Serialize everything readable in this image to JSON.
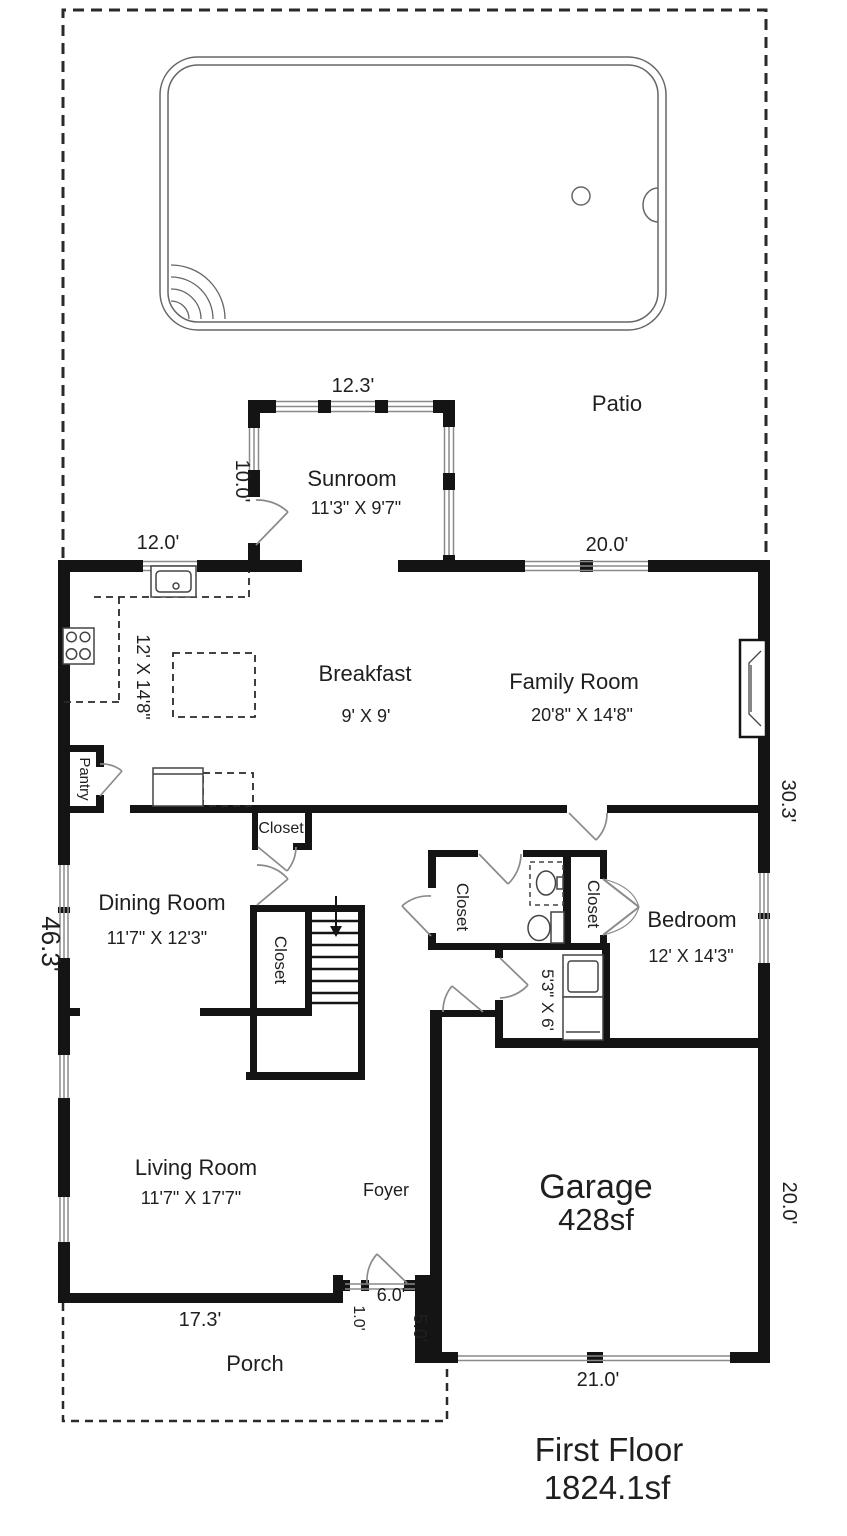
{
  "title": {
    "name": "First Floor",
    "area": "1824.1sf"
  },
  "outdoor": {
    "patio": "Patio",
    "porch": "Porch"
  },
  "rooms": {
    "sunroom": {
      "name": "Sunroom",
      "dims": "11'3\" X 9'7\""
    },
    "kitchen": {
      "dims": "12' X 14'8\""
    },
    "breakfast": {
      "name": "Breakfast",
      "dims": "9' X 9'"
    },
    "family_room": {
      "name": "Family Room",
      "dims": "20'8\" X 14'8\""
    },
    "dining_room": {
      "name": "Dining Room",
      "dims": "11'7\" X 12'3\""
    },
    "bedroom": {
      "name": "Bedroom",
      "dims": "12' X 14'3\""
    },
    "living_room": {
      "name": "Living Room",
      "dims": "11'7\" X 17'7\""
    },
    "foyer": {
      "name": "Foyer"
    },
    "garage": {
      "name": "Garage",
      "area": "428sf"
    },
    "pantry": {
      "name": "Pantry"
    },
    "laundry": {
      "dims": "5'3\" X 6'"
    },
    "hall_closet": {
      "name": "Closet"
    },
    "stair_closet": {
      "name": "Closet"
    },
    "left_closet": {
      "name": "Closet"
    },
    "bedroom_closet": {
      "name": "Closet"
    }
  },
  "dimensions": {
    "sunroom_width": "12.3'",
    "sunroom_depth": "10.0'",
    "kitchen_window": "12.0'",
    "family_window": "20.0'",
    "left_side": "46.3'",
    "right_side": "30.3'",
    "living_width": "17.3'",
    "entry_side": "1.0'",
    "entry_width": "6.0'",
    "garage_offset": "5.0'",
    "garage_width": "21.0'",
    "garage_depth": "20.0'"
  },
  "colors": {
    "wall": "#141414",
    "thin_line": "#8a8a8a",
    "dashed": "#2a2a2a",
    "text": "#1f1f1f",
    "background": "#ffffff"
  }
}
